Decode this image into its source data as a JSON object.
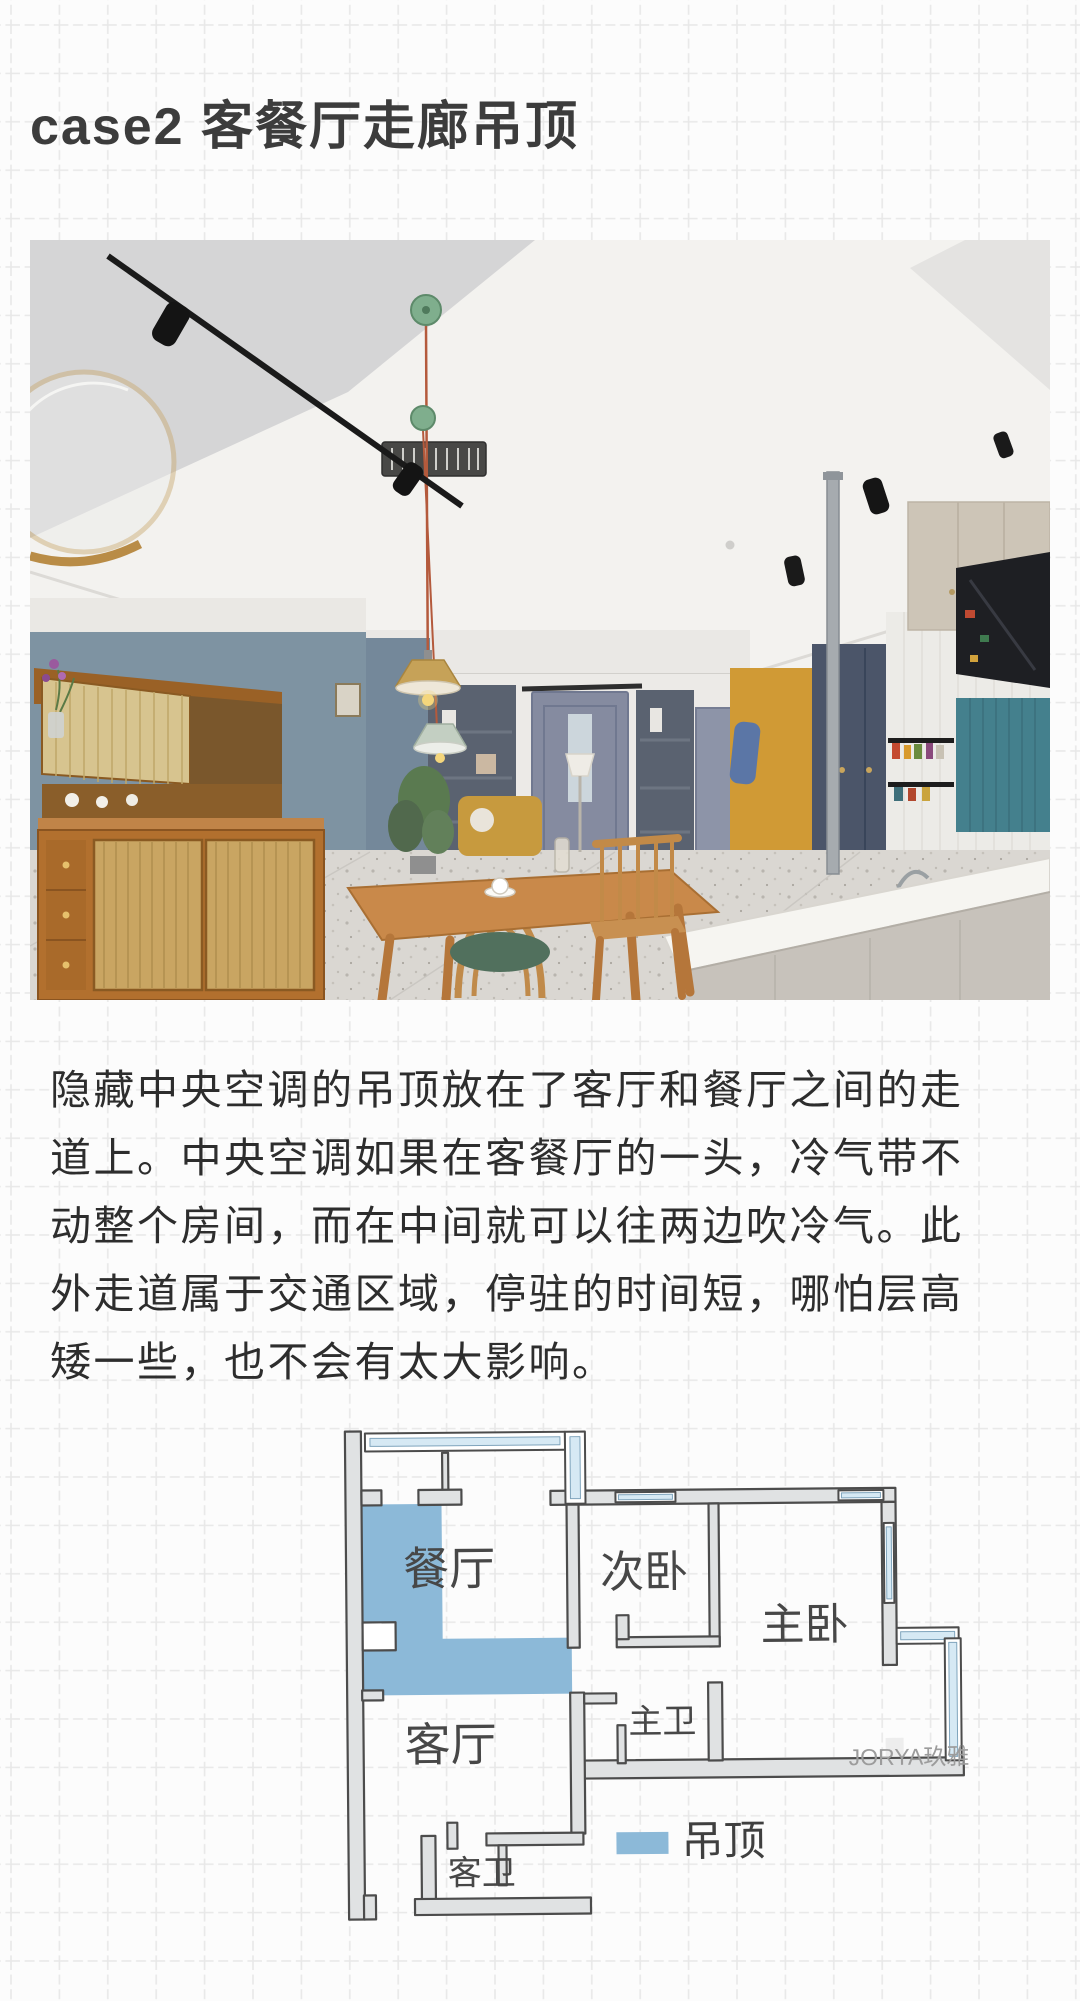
{
  "title": "case2 客餐厅走廊吊顶",
  "body": {
    "lines": [
      "隐藏中央空调的吊顶放在了客厅和餐厅之间的走",
      "道上。中央空调如果在客餐厅的一头，冷气带不",
      "动整个房间，而在中间就可以往两边吹冷气。此",
      "外走道属于交通区域，停驻的时间短，哪怕层高",
      "矮一些，也不会有太大影响。"
    ]
  },
  "floorplan": {
    "labels": {
      "dining": "餐厅",
      "second_bedroom": "次卧",
      "master_bedroom": "主卧",
      "living": "客厅",
      "master_bath": "主卫",
      "guest_bath": "客卫"
    },
    "legend_label": "吊顶",
    "watermark": "JORYA玖雅",
    "colors": {
      "highlight": "#8cb9d8",
      "wall_fill": "#e0e2e3",
      "wall_stroke": "#4c4c4c",
      "window": "#d6e9f4"
    }
  }
}
